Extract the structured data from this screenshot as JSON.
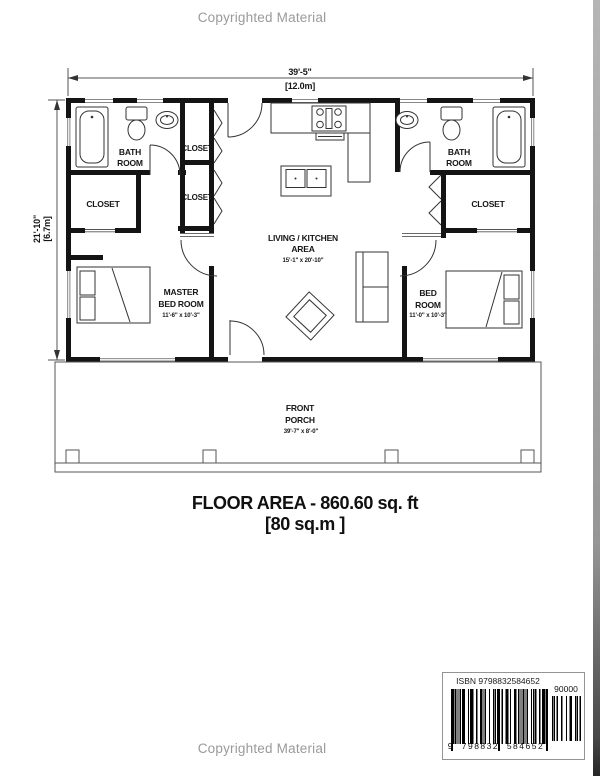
{
  "page": {
    "copyright_top": "Copyrighted Material",
    "copyright_bottom": "Copyrighted Material"
  },
  "plan": {
    "dim_width_ft": "39'-5\"",
    "dim_width_m": "[12.0m]",
    "dim_height_ft": "21'-10\"",
    "dim_height_m": "[6.7m]",
    "rooms": {
      "bath_left_1": "BATH",
      "bath_left_2": "ROOM",
      "closet_left": "CLOSET",
      "closet_mid_top": "CLOSET",
      "closet_mid_bottom": "CLOSET",
      "living_1": "LIVING / KITCHEN",
      "living_2": "AREA",
      "living_dim": "15'-1\" x 20'-10\"",
      "master_1": "MASTER",
      "master_2": "BED ROOM",
      "master_dim": "11'-6\" x 10'-3\"",
      "bath_right_1": "BATH",
      "bath_right_2": "ROOM",
      "closet_right": "CLOSET",
      "bed2_1": "BED",
      "bed2_2": "ROOM",
      "bed2_dim": "11'-0\" x 10'-3\"",
      "porch_1": "FRONT",
      "porch_2": "PORCH",
      "porch_dim": "39'-7\" x 8'-0\""
    },
    "floor_area_line1": "FLOOR AREA - 860.60 sq. ft",
    "floor_area_line2": "[80 sq.m ]"
  },
  "barcode": {
    "isbn_label": "ISBN 9798832584652",
    "price_code": "90000",
    "digits": "9  798832  584652"
  },
  "colors": {
    "ink": "#161616",
    "wall": "#141414",
    "muted_gray": "#9a9a9a"
  }
}
